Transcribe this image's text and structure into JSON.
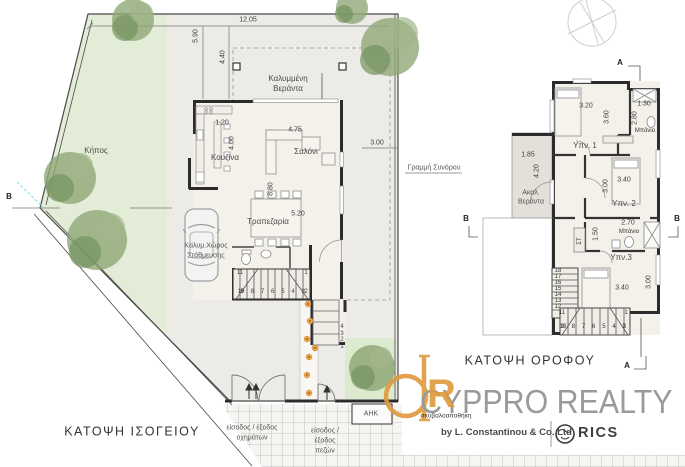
{
  "ground": {
    "title": "ΚΑΤΟΨΗ ΙΣΟΓΕΙΟΥ",
    "garden": "Κήπος",
    "veranda1": "Καλυμμένη",
    "veranda2": "Βεράντα",
    "kitchen": "Κουζίνα",
    "living": "Σαλόνι",
    "dining": "Τραπεζαρία",
    "parking1": "Καλυμ.Χώρος",
    "parking2": "Στάθμευσης",
    "boundary": "Γραμμή Συνόρου",
    "ahk": "ΑΗΚ",
    "trash": "σκυβαλοαποθήκη",
    "veh1": "είσοδος / έξοδος",
    "veh2": "οχημάτων",
    "ped1": "είσοδος /",
    "ped2": "έξοδος",
    "ped3": "πεζών",
    "d_1205": "12.05",
    "d_590": "5.90",
    "d_440": "4.40",
    "d_120": "1.20",
    "d_400": "4.00",
    "d_475": "4.75",
    "d_300": "3.00",
    "d_880": "8.80",
    "d_520": "5.20",
    "s11": "11",
    "s1": "1",
    "s10": "10",
    "srow": "9 8 7 6 5 4 3",
    "s2": "2",
    "g4": "4",
    "g3": "3",
    "g2": "2",
    "g1": "1",
    "secB": "B"
  },
  "upper": {
    "title": "ΚΑΤΟΨΗ ΟΡΟΦΟΥ",
    "bed1": "Υπν. 1",
    "bed2": "Υπν. 2",
    "bed3": "Υπν.3",
    "bath1": "Μπάνιο",
    "bath2": "Μπάνιο",
    "veranda1": "Ακαλ.",
    "veranda2": "Βεράντα",
    "closet": "ΣΤ",
    "d_320": "3.20",
    "d_360": "3.60",
    "d_130": "1.30",
    "d_280": "2.80",
    "d_185": "1.85",
    "d_420": "4.20",
    "d_340a": "3.40",
    "d_300a": "3.00",
    "d_270": "2.70",
    "d_150": "1.50",
    "d_340b": "3.40",
    "d_300b": "3.00",
    "st": [
      "18",
      "17",
      "16",
      "15",
      "14",
      "13",
      "12"
    ],
    "s11": "11",
    "s10": "10",
    "srow": "9 8 7 6 5 4 3",
    "s2": "2",
    "s1": "1",
    "secA": "A",
    "secB": "B"
  },
  "logo": {
    "brand": "CYPPRO REALTY",
    "byline": "by L. Constantinou & Co. Ltd",
    "rics": "RICS",
    "monogram_r": "R"
  },
  "colors": {
    "accent_orange": "#DF9A3C",
    "brand_gray": "#9a9a9a",
    "rics_dark": "#3f3f3f",
    "garden_green": "#e3ecd6",
    "wall_dark": "#2b2b2b",
    "flower_orange": "#EDAD4A"
  }
}
